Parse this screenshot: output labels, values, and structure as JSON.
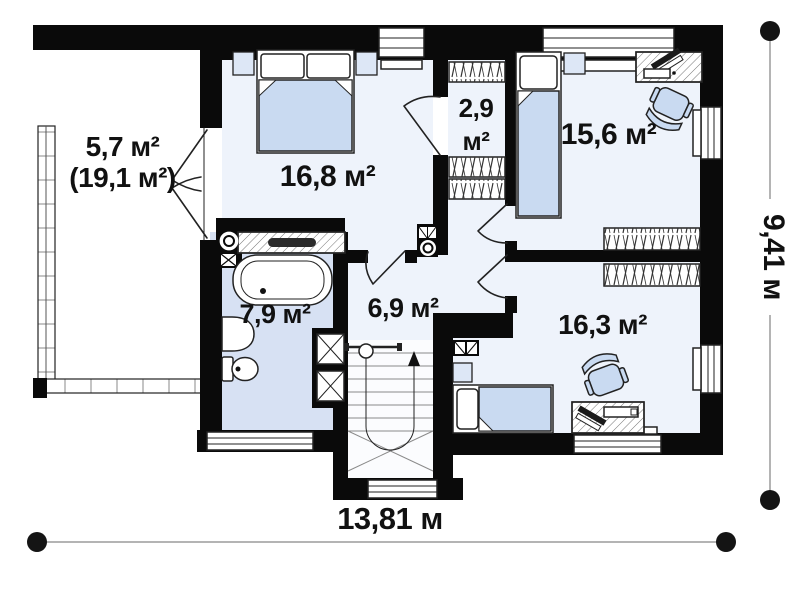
{
  "rooms": {
    "terrace": {
      "area": "5,7 м²",
      "area_total": "(19,1 м²)"
    },
    "bedroom": {
      "area": "16,8 м²"
    },
    "wardrobe": {
      "area_value": "2,9",
      "area_unit": "м²"
    },
    "bedroom2": {
      "area": "15,6 м²"
    },
    "bathroom": {
      "area": "7,9 м²"
    },
    "hallway": {
      "area": "6,9 м²"
    },
    "bedroom3": {
      "area": "16,3 м²"
    }
  },
  "dimensions": {
    "width": "13,81 м",
    "height": "9,41 м"
  },
  "colors": {
    "wall": "#0a0a0a",
    "floor": "#eef3fb",
    "bath_floor": "#d7e1f3",
    "furniture": "#c9daf1",
    "accent_light": "#dde7f6",
    "label": "#111111",
    "dim_line": "#9b9b9b",
    "stair_line": "#8a8a8a"
  }
}
